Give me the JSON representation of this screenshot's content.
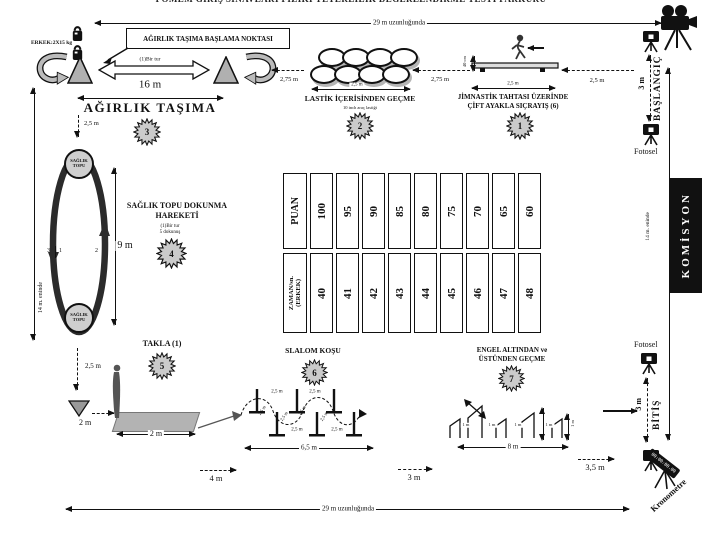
{
  "title": "POMEM GİRİŞ SINAVLARI FİZİKİ YETERLİLİK DEĞERLENDİRME TESTİ PARKURU",
  "course": {
    "length_top": "29 m uzunluğunda",
    "length_bottom": "29 m uzunluğunda",
    "width_left": "14 m. eninde",
    "width_right": "14 m. eninde"
  },
  "weight_carry": {
    "weights": "ERKEK:2X15 kg",
    "start_box": "AĞIRLIK TAŞIMA BAŞLAMA NOKTASI",
    "one_lap": "(1)Bir tur",
    "track_length": "16 m",
    "name": "AĞIRLIK TAŞIMA",
    "number": "3",
    "offset": "2,5 m"
  },
  "tires": {
    "name": "LASTİK İÇERİSİNDEN GEÇME",
    "note": "10 inch araç lastiği",
    "number": "2",
    "gap_left": "2,75 m",
    "gap_right": "2,75 m",
    "width": "2,5 m"
  },
  "gym_board": {
    "name_line1": "JİMNASTİK TAHTASI ÜZERİNDE",
    "name_line2": "ÇİFT AYAKLA SIÇRAYIŞ (6)",
    "number": "1",
    "height": "40 cm",
    "width": "2,5 m",
    "gap_right": "2,5 m"
  },
  "medicine_ball": {
    "name_line1": "SAĞLIK TOPU DOKUNMA",
    "name_line2": "HAREKETİ",
    "note_line1": "(1)Bir tur",
    "note_line2": "5 dokunuş",
    "number": "4",
    "length": "9 m",
    "ball_label": "SAĞLIK TOPU",
    "marks": [
      "3",
      "1",
      "2"
    ]
  },
  "somersault": {
    "name": "TAKLA (1)",
    "number": "5",
    "offset": "2,5 m",
    "cone_gap": "2 m",
    "mat_width": "2 m"
  },
  "slalom": {
    "name": "SLALOM KOŞU",
    "number": "6",
    "gap": "2,5 m",
    "total": "6,5 m"
  },
  "hurdles": {
    "name_line1": "ENGEL ALTINDAN ve",
    "name_line2": "ÜSTÜNDEN GEÇME",
    "number": "7",
    "gap": "1 m",
    "height": "1 m",
    "total": "8 m"
  },
  "gaps": {
    "d4": "4 m",
    "d3": "3 m",
    "d35": "3,5 m"
  },
  "timing": {
    "start": "BAŞLANGIÇ",
    "finish": "BİTİŞ",
    "photocell": "Fotosel",
    "commission": "KOMİSYON",
    "chronometer": "Kronometre",
    "stopwatch": "00:00:00.00",
    "start_zone": "3 m",
    "finish_zone": "3 m"
  },
  "score_table": {
    "score_header": "PUAN",
    "scores": [
      "100",
      "95",
      "90",
      "85",
      "80",
      "75",
      "70",
      "65",
      "60"
    ],
    "time_header_line1": "ZAMAN/sn.",
    "time_header_line2": "(ERKEK)",
    "times": [
      "40",
      "41",
      "42",
      "43",
      "44",
      "45",
      "46",
      "47",
      "48"
    ]
  }
}
